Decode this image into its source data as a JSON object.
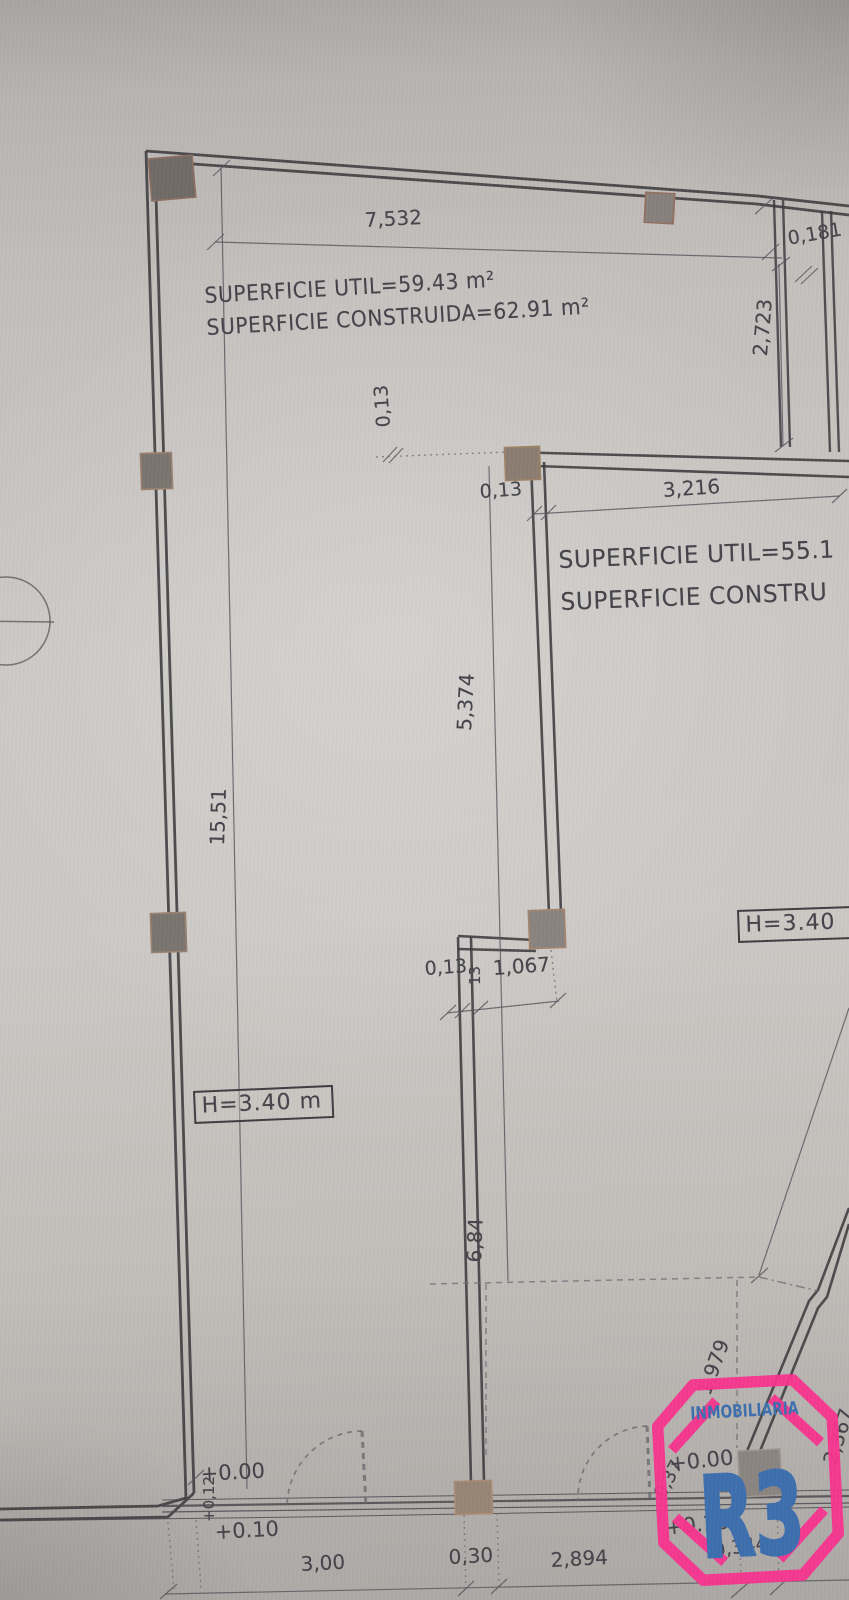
{
  "plan": {
    "unit_a": {
      "util": "SUPERFICIE UTIL=59.43 m²",
      "construida": "SUPERFICIE CONSTRUIDA=62.91 m²",
      "height": "H=3.40 m"
    },
    "unit_b": {
      "util": "SUPERFICIE UTIL=55.1",
      "construida": "SUPERFICIE CONSTRU",
      "height": "H=3.40"
    },
    "dims": {
      "top_width": "7,532",
      "left_height": "15,51",
      "niche_width": "0,181",
      "niche_height": "2,723",
      "thk_top": "0,13",
      "thk_mid": "0,13",
      "span_right": "3,216",
      "partition_upper": "5,374",
      "thk_corner": "0,13",
      "thk_corner_small": "13",
      "corner_offset": "1,067",
      "partition_lower": "6,84",
      "diag_upper": "1,979",
      "diag_lower": "2,367",
      "diag_door": "0,37",
      "bottom_a": "3,00",
      "bottom_b": "0,30",
      "bottom_c": "2,894",
      "bottom_d": "0,344"
    },
    "levels": {
      "zero_left": "+0.00",
      "step_left": "+0,12",
      "ten_left": "+0.10",
      "zero_right": "+0.00",
      "ten_right": "+0.10"
    }
  },
  "logo": {
    "tagline": "INMOBILIARIA",
    "mark": "R3",
    "pink": "#f8348f",
    "blue": "#3e6fae"
  },
  "colors": {
    "paper": "#c7c4c1",
    "ink": "#3d3c42",
    "pillar": "#7b7570"
  }
}
